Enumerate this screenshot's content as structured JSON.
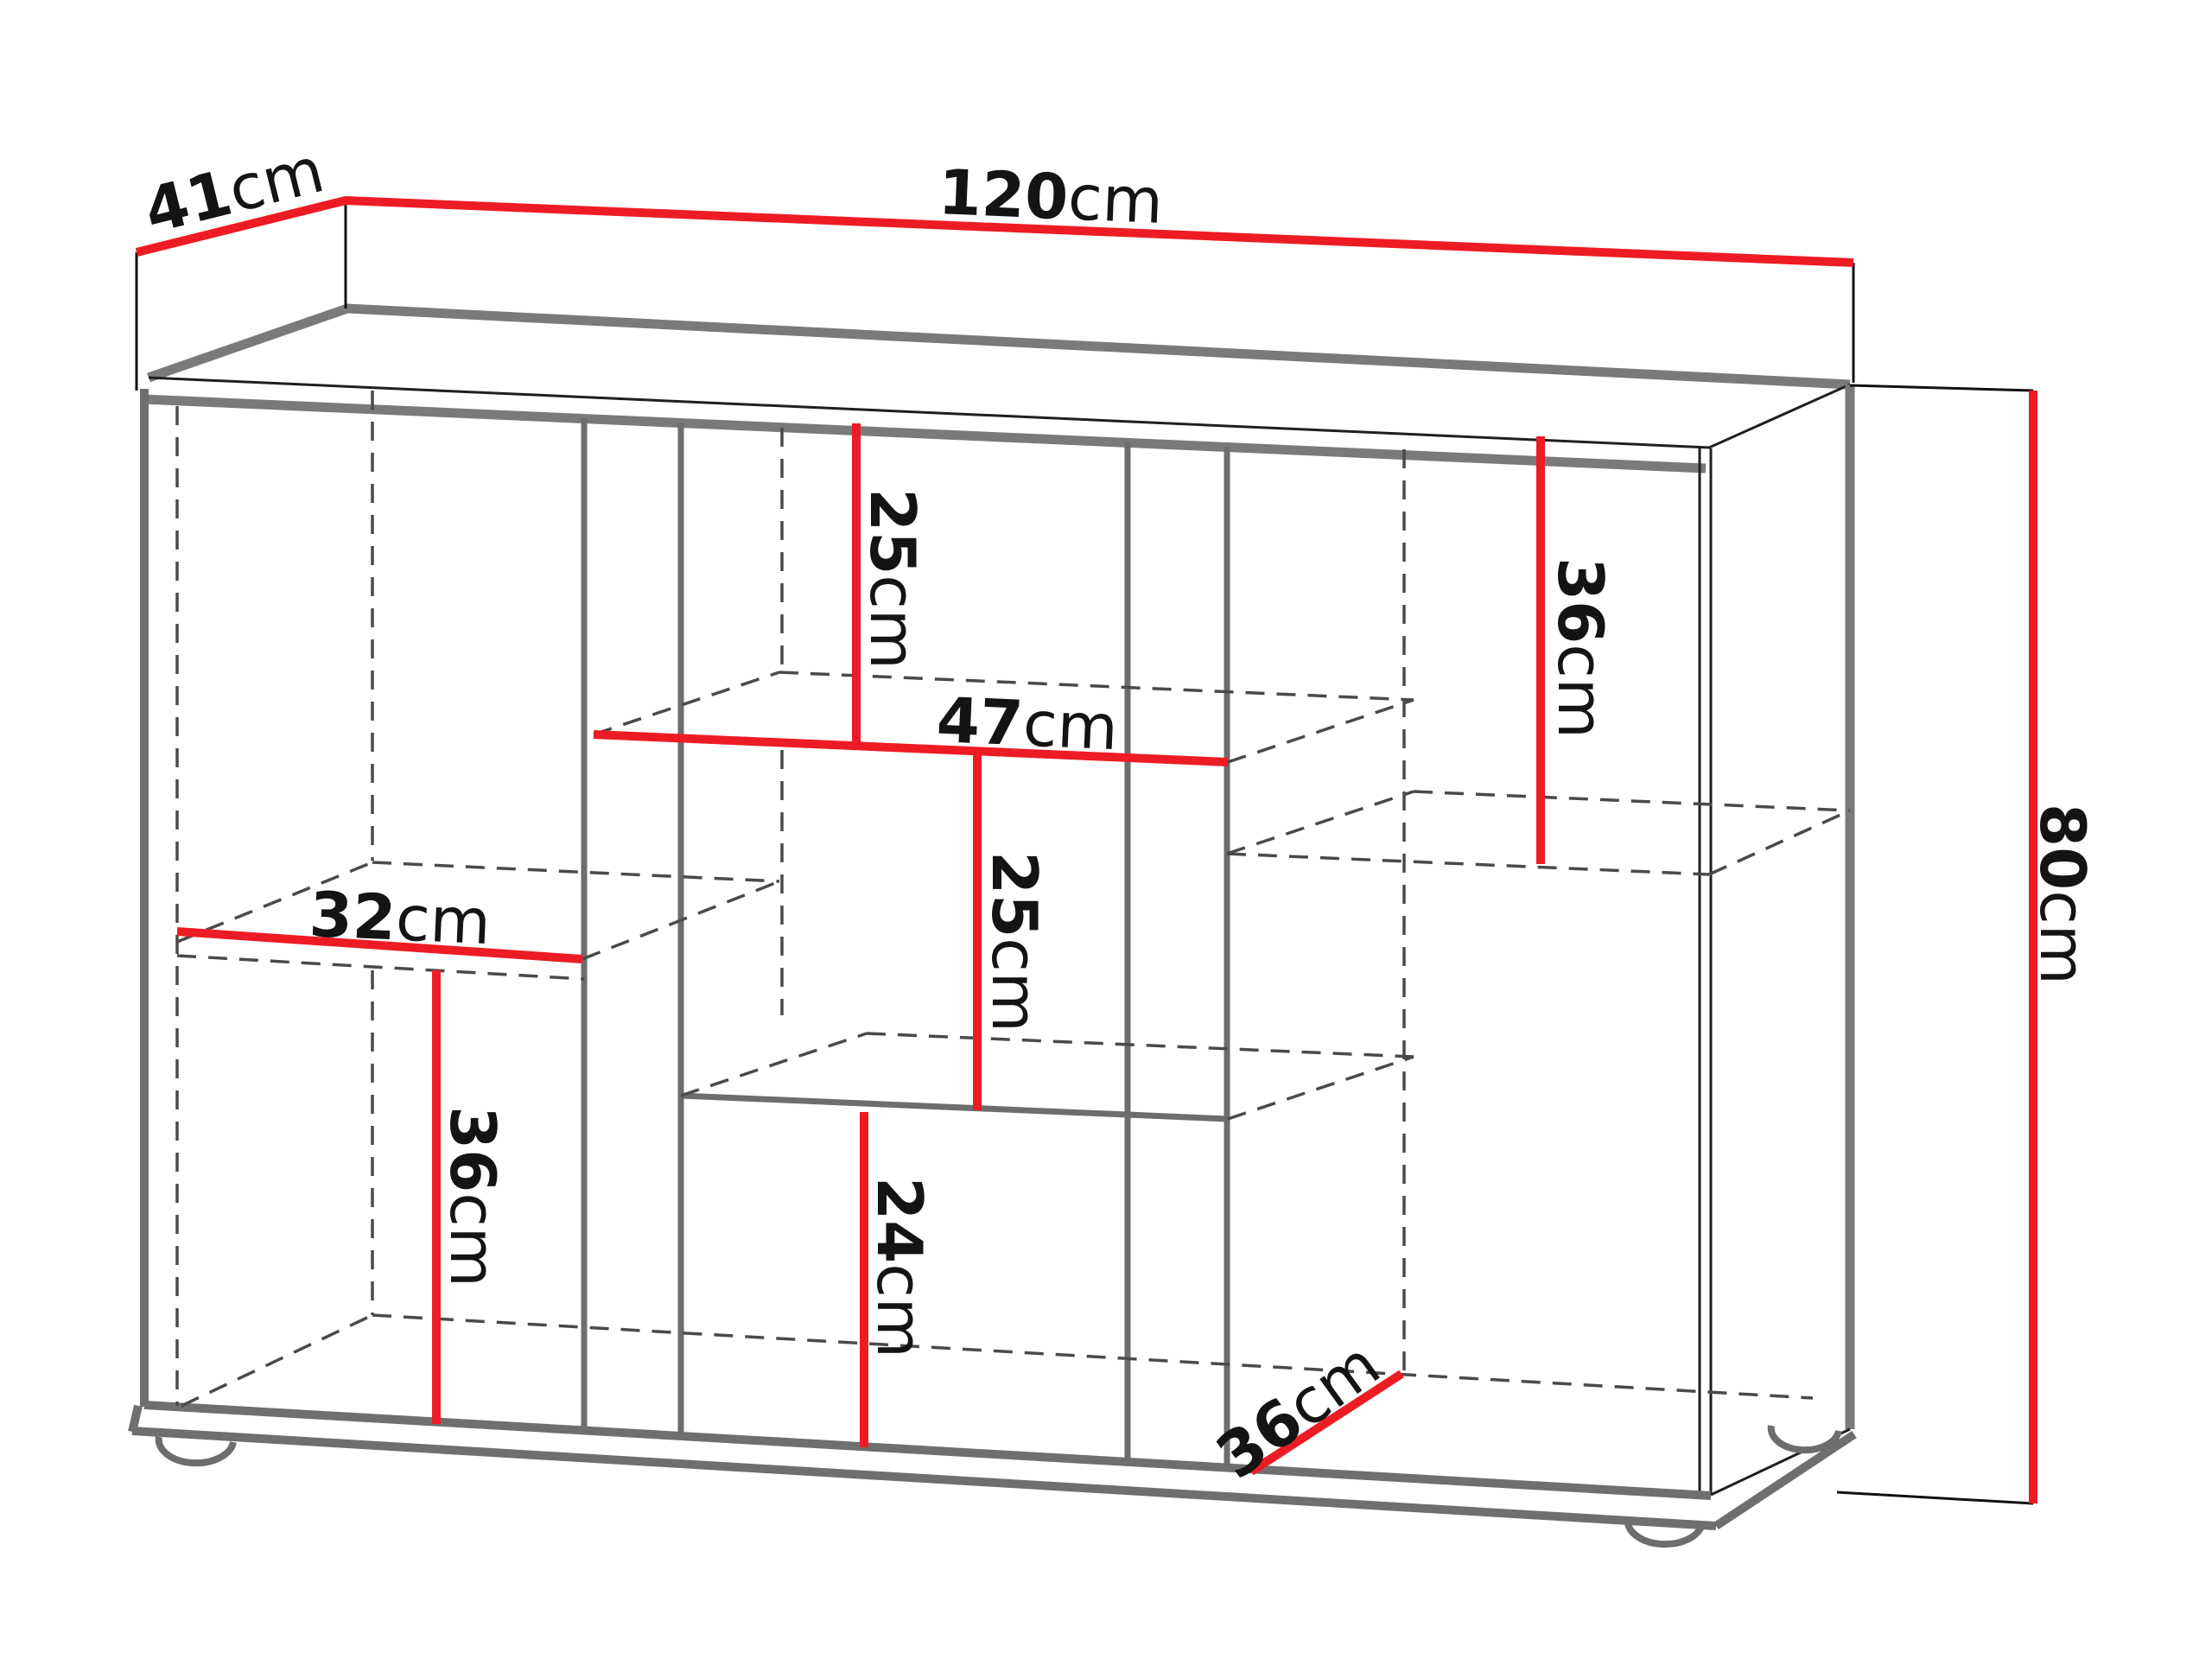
{
  "diagram": {
    "kind": "furniture-dimension-diagram",
    "object": "sideboard cabinet line drawing with red dimension lines",
    "unit": "cm",
    "colors": {
      "dimension_line": "#ed1c24",
      "outline_gray": "#7a7a7a",
      "hidden_line_gray": "#4a4a4a",
      "edge_black": "#1f1f1f",
      "label_text": "#141414",
      "background": "#ffffff"
    },
    "overall": {
      "width_cm": 120,
      "depth_cm": 41,
      "height_cm": 80
    },
    "labels": {
      "width": {
        "num": "120",
        "unit": "cm"
      },
      "depth": {
        "num": "41",
        "unit": "cm"
      },
      "height": {
        "num": "80",
        "unit": "cm"
      },
      "top_middle_gap": {
        "num": "25",
        "unit": "cm"
      },
      "middle_width": {
        "num": "47",
        "unit": "cm"
      },
      "middle_gap": {
        "num": "25",
        "unit": "cm"
      },
      "bottom_middle_gap": {
        "num": "24",
        "unit": "cm"
      },
      "right_gap": {
        "num": "36",
        "unit": "cm"
      },
      "left_shelf_width": {
        "num": "32",
        "unit": "cm"
      },
      "left_gap": {
        "num": "36",
        "unit": "cm"
      },
      "bottom_depth": {
        "num": "36",
        "unit": "cm"
      }
    },
    "measurements": [
      {
        "id": "width",
        "value": 120,
        "unit": "cm",
        "refers_to": "overall cabinet width (top back edge)"
      },
      {
        "id": "depth",
        "value": 41,
        "unit": "cm",
        "refers_to": "overall cabinet depth (top left edge)"
      },
      {
        "id": "height",
        "value": 80,
        "unit": "cm",
        "refers_to": "overall cabinet height (right side)"
      },
      {
        "id": "top_middle_gap",
        "value": 25,
        "unit": "cm",
        "refers_to": "height from top to middle shelf"
      },
      {
        "id": "middle_width",
        "value": 47,
        "unit": "cm",
        "refers_to": "width of middle compartment"
      },
      {
        "id": "middle_gap",
        "value": 25,
        "unit": "cm",
        "refers_to": "height of middle compartment below shelf"
      },
      {
        "id": "bottom_middle_gap",
        "value": 24,
        "unit": "cm",
        "refers_to": "height of lower middle compartment"
      },
      {
        "id": "right_gap",
        "value": 36,
        "unit": "cm",
        "refers_to": "height of right compartment above shelf"
      },
      {
        "id": "left_shelf_width",
        "value": 32,
        "unit": "cm",
        "refers_to": "width of left shelf"
      },
      {
        "id": "left_gap",
        "value": 36,
        "unit": "cm",
        "refers_to": "height of left compartment below shelf"
      },
      {
        "id": "bottom_depth",
        "value": 36,
        "unit": "cm",
        "refers_to": "depth of bottom right compartment"
      }
    ]
  }
}
